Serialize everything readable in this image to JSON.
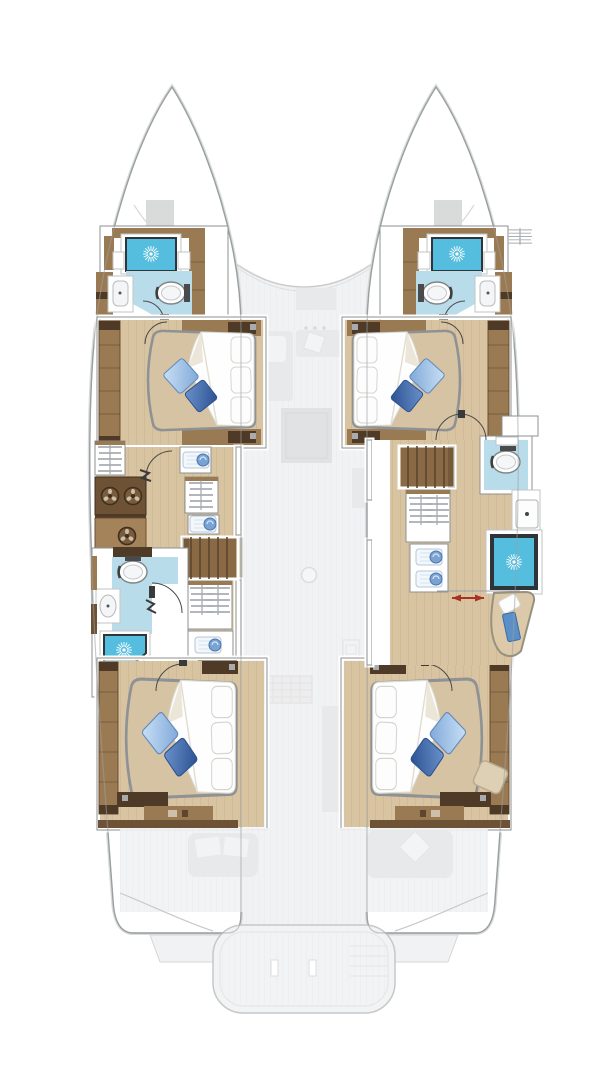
{
  "meta": {
    "title": "Catamaran yacht floor plan — lower deck (4-cabin hull layout), top-down view",
    "type": "boat-floorplan",
    "view": "top-down",
    "decks_shown": [
      "hull accommodation deck (solid)",
      "main deck saloon & cockpit (ghosted)"
    ]
  },
  "colors": {
    "hull-outline": "#9aa0a3",
    "hull-outline-soft": "#d9dbdc",
    "ghost": "#f1f2f3",
    "ghost-dark": "#e8e9ea",
    "ghost-darker": "#e0e2e3",
    "ghost-line": "#c7c9cb",
    "wood": "#9a7a52",
    "wood-mid": "#a5835a",
    "wood-dark": "#6e5236",
    "wood-deep": "#4e3a26",
    "floor": "#d9c4a2",
    "bath-floor": "#b9dcea",
    "shower": "#55bedf",
    "mattress": "#d6c3a4",
    "wall-line": "#8d9092",
    "bed-stroke": "#8f9294",
    "arrow-red": "#a93226",
    "towel-blue": "#7aa3d4",
    "chaise-towel": "#5b8fc7"
  },
  "legend": {
    "sun-burst-icon": "shower head / shower tray",
    "hanger-icon": "hanging wardrobe locker",
    "double-arrow-icon": "sliding door travel direction",
    "quarter-arc": "door swing",
    "striped-block": "companionway stairs from saloon"
  },
  "hulls": {
    "port": {
      "rooms": [
        {
          "name": "forward bathroom",
          "fixtures": [
            "shower cubicle",
            "toilet",
            "washbasin"
          ]
        },
        {
          "name": "forward double cabin",
          "fixtures": [
            "island double bed",
            "wardrobe shelving",
            "head & foot cabinets",
            "2 blue deco pillows",
            "3 white pillows"
          ]
        },
        {
          "name": "midship corridor / utility",
          "fixtures": [
            "hanging lockers",
            "3 round utility fixtures",
            "linen shelves",
            "companionway stairs"
          ]
        },
        {
          "name": "midship bathroom",
          "fixtures": [
            "toilet",
            "washbasin",
            "corner shower"
          ]
        },
        {
          "name": "aft double cabin",
          "fixtures": [
            "island double bed",
            "wardrobe shelving",
            "bench seat",
            "aft cabinets"
          ]
        }
      ]
    },
    "starboard": {
      "rooms": [
        {
          "name": "forward bathroom",
          "fixtures": [
            "shower cubicle",
            "toilet",
            "washbasin"
          ]
        },
        {
          "name": "forward double cabin",
          "fixtures": [
            "island double bed",
            "wardrobe shelving",
            "head & foot cabinets",
            "2 blue deco pillows",
            "3 white pillows"
          ]
        },
        {
          "name": "midship corridor / dressing",
          "fixtures": [
            "companionway stairs",
            "separate toilet room",
            "vanity washbasin",
            "square shower",
            "hanging lockers",
            "linen shelves",
            "chaise seat with towel",
            "sliding door (red arrow)"
          ]
        },
        {
          "name": "aft double cabin",
          "fixtures": [
            "island double bed",
            "wardrobe shelving",
            "bench seat",
            "ottoman stool"
          ]
        }
      ]
    }
  },
  "ghost_deck": {
    "foredeck": [
      "deck hatch port",
      "deck hatch starboard",
      "coachroof curve"
    ],
    "saloon": [
      "L-sofa with pillows",
      "chaise",
      "rug",
      "round table dot",
      "galley counters",
      "galley mat",
      "appliances"
    ],
    "cockpit": [
      "port bench",
      "starboard sofa with diamond pillow",
      "transom steps platform"
    ]
  },
  "counts": {
    "double_beds": 4,
    "bathrooms": 3,
    "separate_toilet_rooms": 1,
    "showers": 4,
    "stairs": 2
  }
}
